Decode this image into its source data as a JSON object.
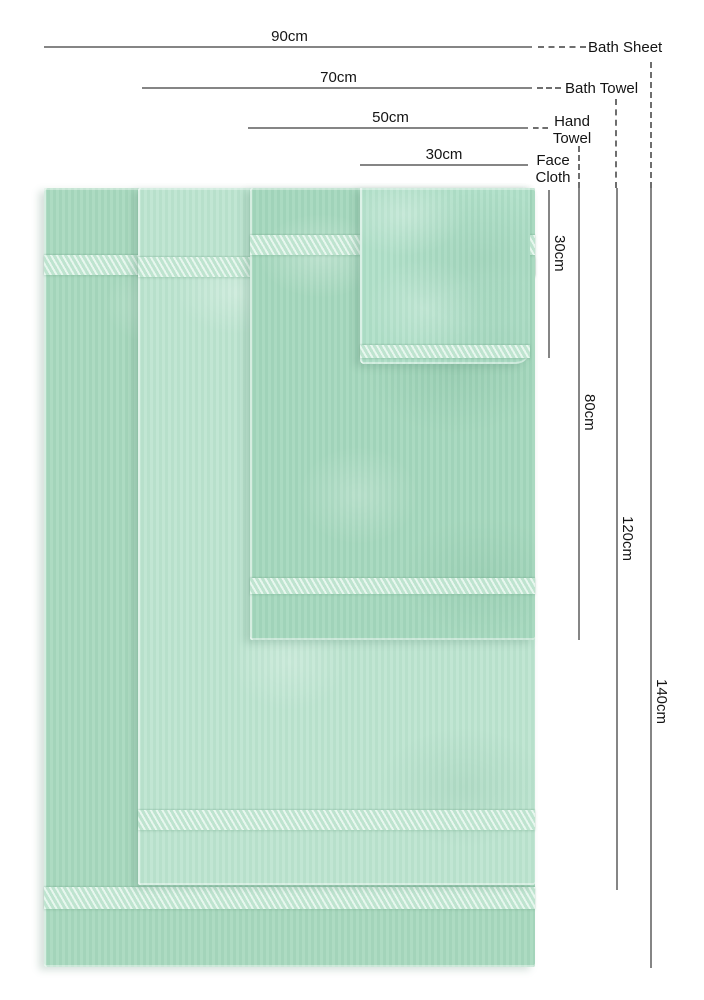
{
  "diagram": {
    "type": "product-size-diagram",
    "subject": "towel size comparison",
    "items": [
      {
        "name": "Bath Sheet",
        "width": "90cm",
        "length": "140cm"
      },
      {
        "name": "Bath Towel",
        "width": "70cm",
        "length": "120cm"
      },
      {
        "name": "Hand Towel",
        "width": "50cm",
        "length": "80cm"
      },
      {
        "name": "Face Cloth",
        "width": "30cm",
        "length": "30cm"
      }
    ],
    "colors": {
      "page_background": "#ffffff",
      "dimension_line": "#858585",
      "connector_dash": "#6e6e6e",
      "label_text": "#141414",
      "bath_sheet": "#a9d9bf",
      "bath_towel": "#bee5d1",
      "hand_towel": "#a6d8be",
      "face_cloth": "#b1e0c9",
      "border_band": "#cfeedd"
    }
  }
}
